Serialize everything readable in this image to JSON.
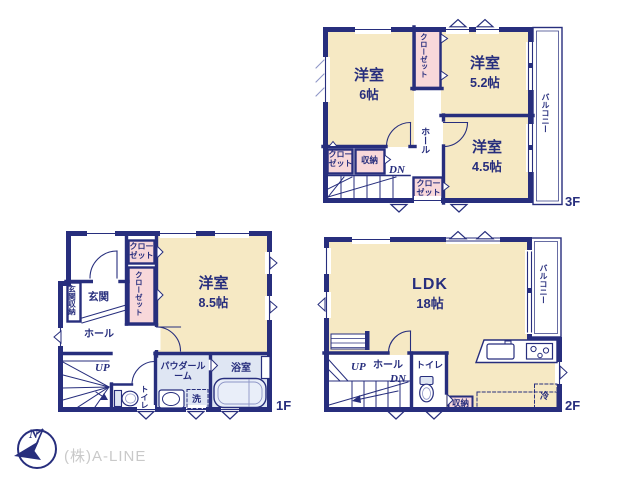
{
  "branding": {
    "company": "(株)A-LINE",
    "compass_n": "N"
  },
  "floor3": {
    "label": "3F",
    "room_a_name": "洋室",
    "room_a_size": "6帖",
    "room_b_name": "洋室",
    "room_b_size": "5.2帖",
    "room_c_name": "洋室",
    "room_c_size": "4.5帖",
    "balcony": "バルコニー",
    "hall": "ホール",
    "down": "DN",
    "closet_mid": "クローゼット",
    "closet_left": "クローゼット",
    "closet_right": "クローゼット",
    "storage": "収納"
  },
  "floor2": {
    "label": "2F",
    "ldk_name": "LDK",
    "ldk_size": "18帖",
    "balcony": "バルコニー",
    "up": "UP",
    "hall": "ホール",
    "down": "DN",
    "toilet": "トイレ",
    "storage": "収納",
    "fridge": "冷"
  },
  "floor1": {
    "label": "1F",
    "room_name": "洋室",
    "room_size": "8.5帖",
    "entrance": "玄関",
    "entrance_storage": "玄関収納",
    "hall": "ホール",
    "up": "UP",
    "toilet": "トイレ",
    "closet_top": "クローゼット",
    "closet_side": "クローゼット",
    "powder_room": "パウダールーム",
    "laundry": "洗",
    "bath": "浴室"
  }
}
